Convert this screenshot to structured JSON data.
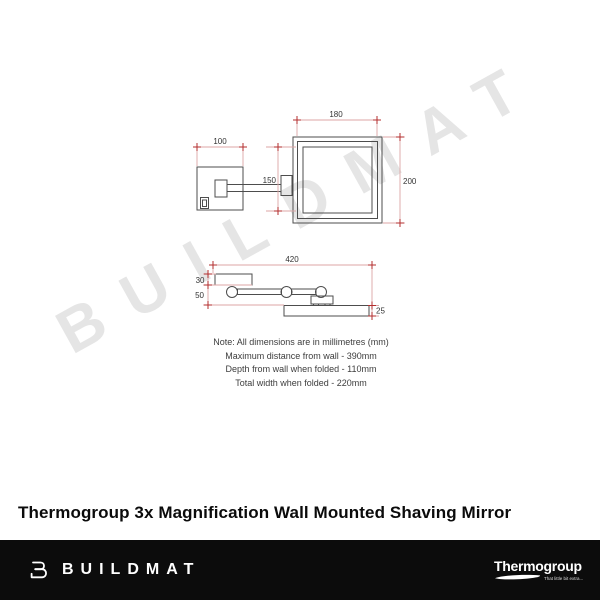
{
  "watermark_text": "BUILDMAT",
  "product": {
    "title": "Thermogroup 3x Magnification Wall Mounted Shaving Mirror"
  },
  "diagram": {
    "front_view": {
      "plate_width": "100",
      "mirror_width": "180",
      "arm_length": "150",
      "mirror_height": "200"
    },
    "top_view": {
      "extended_width": "420",
      "plate_depth": "30",
      "arm_depth": "50",
      "mirror_depth": "25"
    },
    "notes": [
      "Note: All dimensions are in millimetres (mm)",
      "Maximum distance from wall - 390mm",
      "Depth from wall when folded - 110mm",
      "Total width when folded - 220mm"
    ]
  },
  "footer": {
    "buildmat_wordmark": "BUILDMAT",
    "thermogroup_wordmark": "Thermogroup",
    "thermogroup_tagline": "That little bit extra...",
    "background_color": "#0c0c0c"
  },
  "colors": {
    "outline": "#4d4d4d",
    "dimension_line": "#dca6a6",
    "dimension_marker": "#b32e2e",
    "dimension_text": "#333333",
    "watermark": "#e5e5e5"
  }
}
